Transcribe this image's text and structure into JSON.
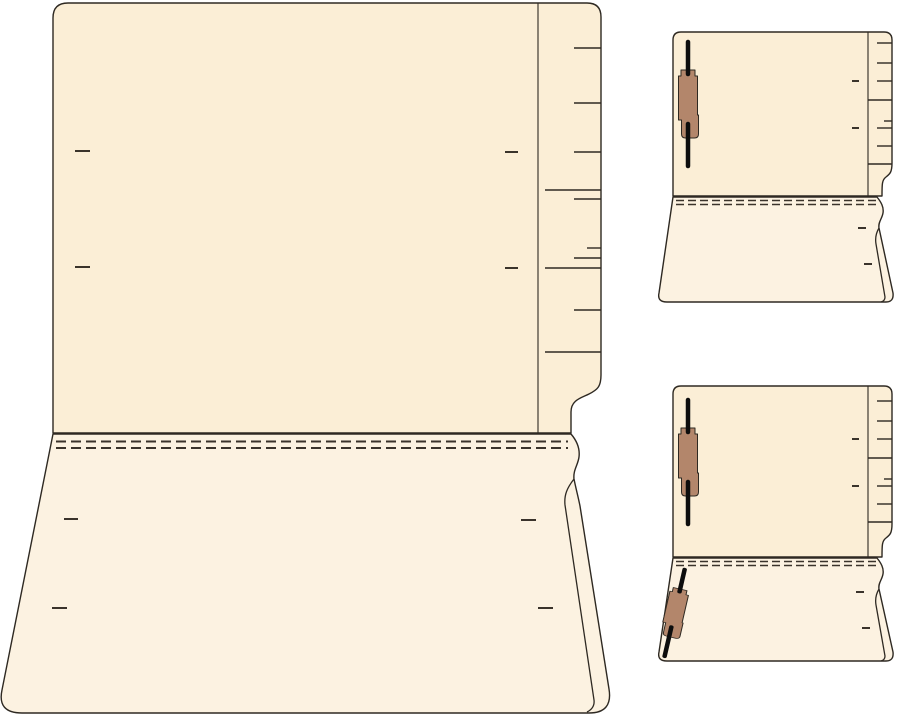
{
  "page": {
    "description": "Line-art product illustration of manila end-tab file folders shown open with fold perforations and prong fasteners"
  },
  "colors": {
    "manila": "#fbeed6",
    "manila_light": "#fcf2e1",
    "outline": "#2e2922",
    "mark": "#3a332b",
    "fastener_base": "#b3866b",
    "fastener_prong": "#0d0d0d",
    "bg": "#ffffff"
  },
  "folders": {
    "large": {
      "label": "Large open end-tab folder, flat view, no fasteners"
    },
    "top_small": {
      "label": "Folded end-tab folder with one fastener on inside back panel"
    },
    "bottom_small": {
      "label": "Folded end-tab folder with two fasteners, front and back panels"
    }
  }
}
